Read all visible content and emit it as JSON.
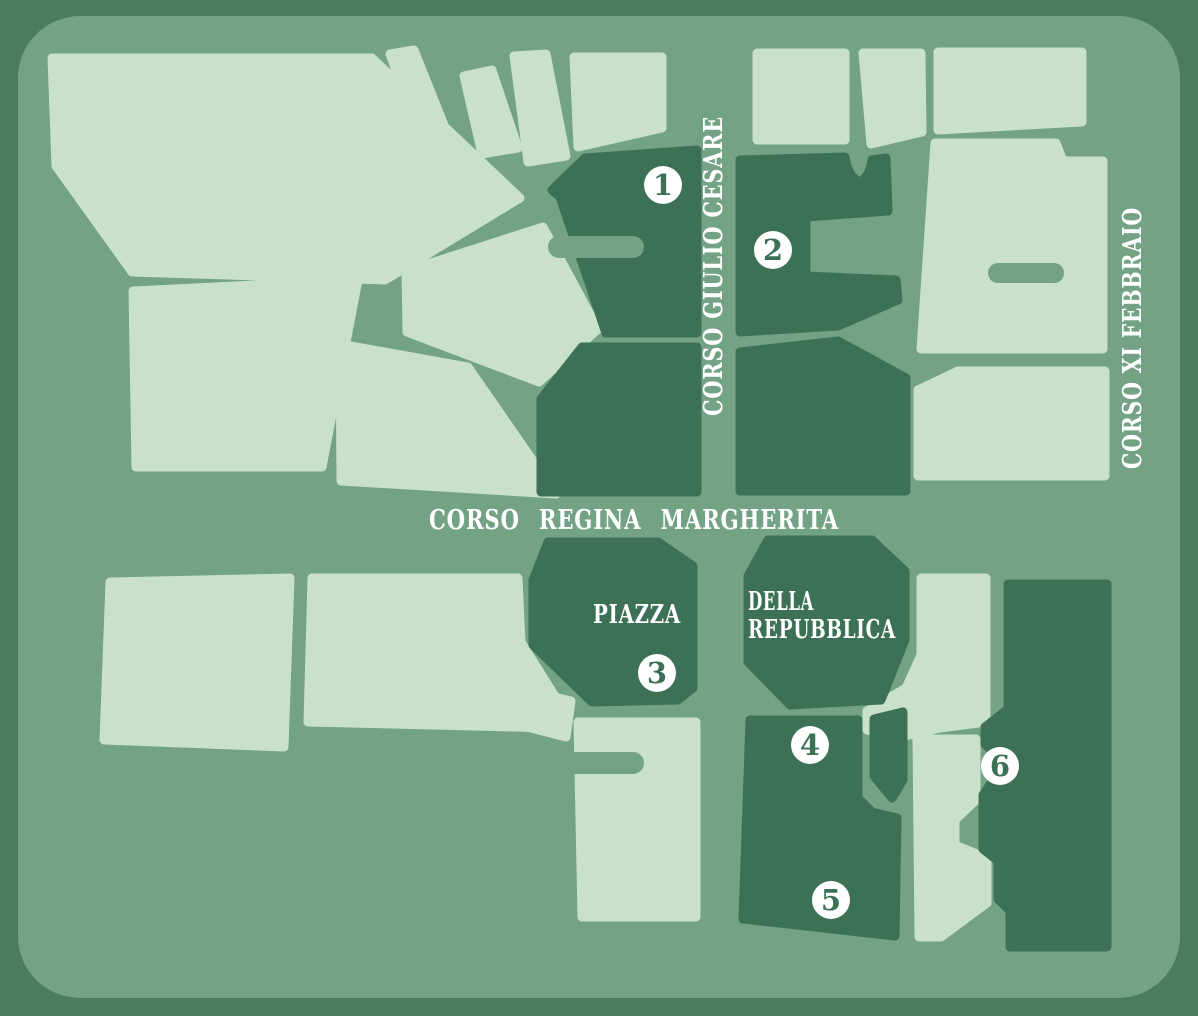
{
  "map": {
    "streets": {
      "corso_giulio_cesare": "CORSO GIULIO CESARE",
      "corso_xi_febbraio": "CORSO XI FEBBRAIO",
      "corso_regina_margherita": "CORSO REGINA MARGHERITA"
    },
    "piazza": {
      "name_line1": "PIAZZA",
      "name_line2": "DELLA",
      "name_line3": "REPUBBLICA"
    },
    "markers": [
      {
        "number": "1",
        "x": 663,
        "y": 185
      },
      {
        "number": "2",
        "x": 773,
        "y": 250
      },
      {
        "number": "3",
        "x": 657,
        "y": 673
      },
      {
        "number": "4",
        "x": 810,
        "y": 745
      },
      {
        "number": "5",
        "x": 831,
        "y": 900
      },
      {
        "number": "6",
        "x": 1000,
        "y": 766
      }
    ],
    "colors": {
      "frame": "#4b7c5e",
      "bg": "#73a285",
      "light": "#c9e0cb",
      "dark": "#3d7156",
      "text": "#ffffff",
      "marker": "#ffffff",
      "marker-num": "#3d7156"
    }
  }
}
